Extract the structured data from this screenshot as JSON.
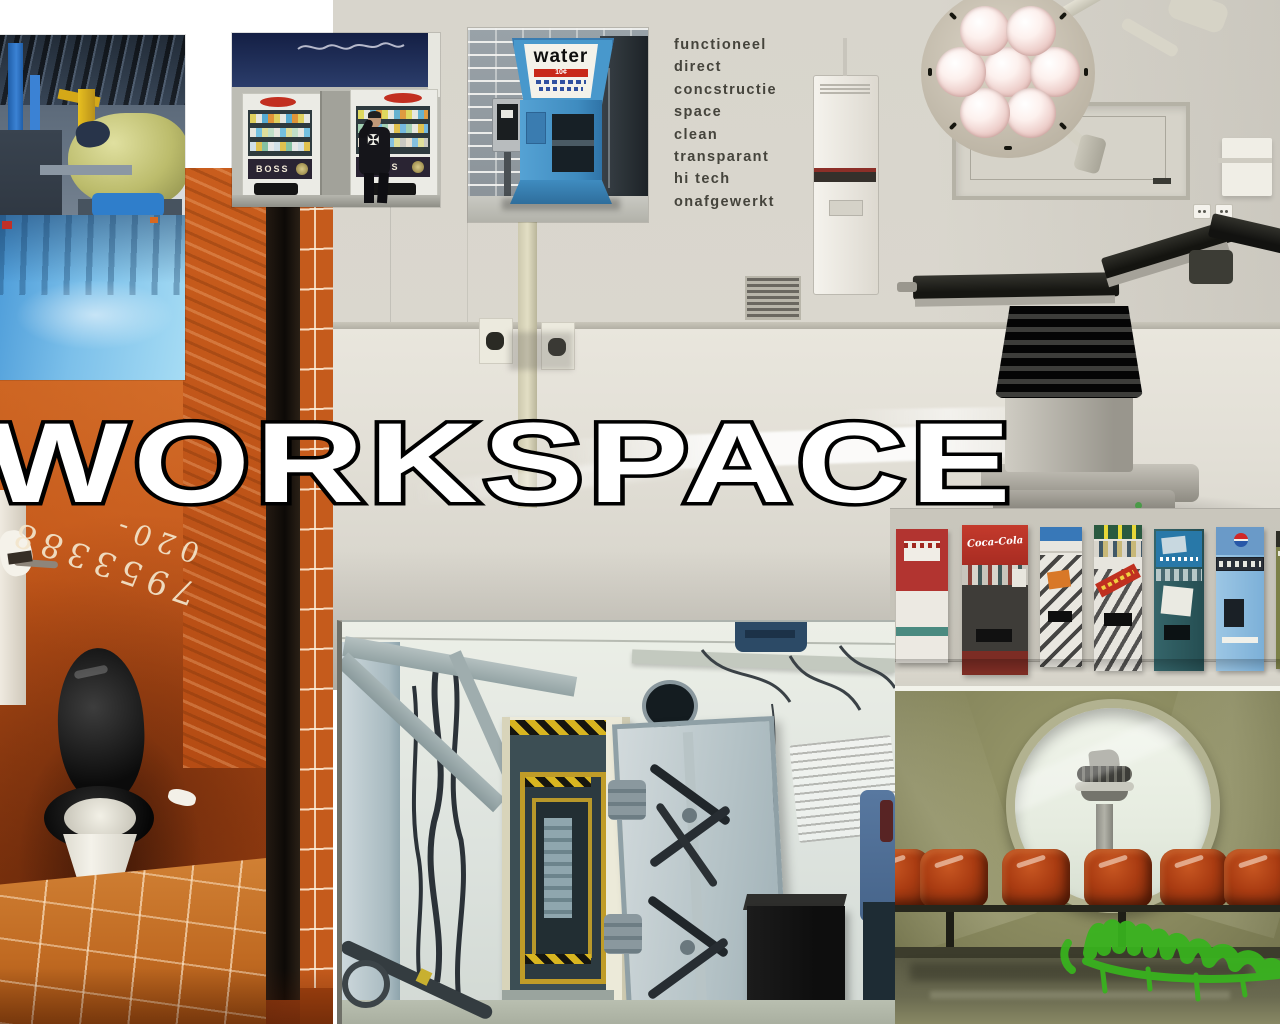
{
  "title": "WORKSPACE",
  "keywords": [
    "functioneel",
    "direct",
    "concstructie",
    "space",
    "clean",
    "transparant",
    "hi tech",
    "onafgewerkt"
  ],
  "photos": {
    "water": {
      "sign": "water",
      "price": "10¢"
    },
    "boss_vending": {
      "brand": "BOSS"
    },
    "machine_row": {
      "coke_brand": "Coca-Cola"
    },
    "bathroom": {
      "graffiti_top": "020-",
      "graffiti_bottom": "7953388"
    }
  },
  "icons": {
    "maltese_cross": "✠"
  },
  "colors": {
    "page_bg": "#ffffff",
    "title_fill": "#ffffff",
    "title_stroke": "#000000",
    "keyword_text": "#45443c",
    "bathroom_orange": "#c25417",
    "water_machine_blue": "#4898cc",
    "graffiti_green": "#38b41e",
    "chair_orange": "#aa3c12",
    "hospital_wall": "#d7d4cb",
    "vault_blue": "#c2ccd0"
  }
}
